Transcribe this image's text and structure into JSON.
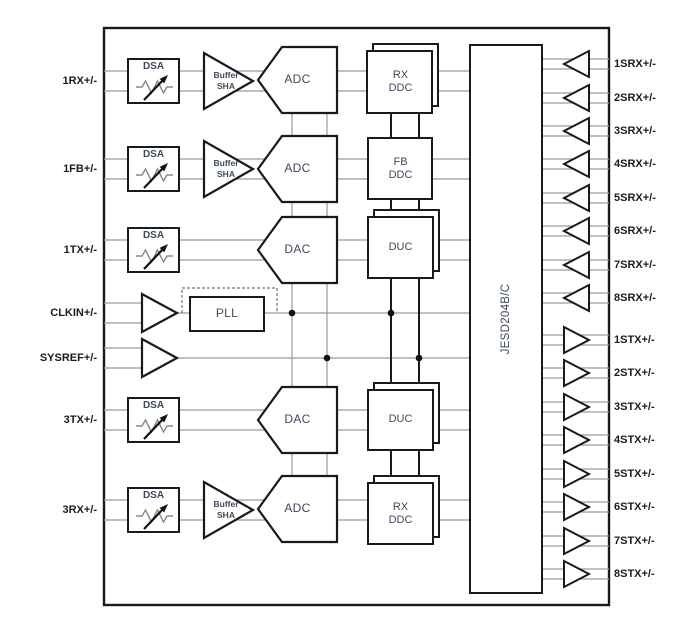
{
  "pins": {
    "left": [
      "1RX+/-",
      "1FB+/-",
      "1TX+/-",
      "CLKIN+/-",
      "SYSREF+/-",
      "3TX+/-",
      "3RX+/-"
    ],
    "srx": [
      "1SRX+/-",
      "2SRX+/-",
      "3SRX+/-",
      "4SRX+/-",
      "5SRX+/-",
      "6SRX+/-",
      "7SRX+/-",
      "8SRX+/-"
    ],
    "stx": [
      "1STX+/-",
      "2STX+/-",
      "3STX+/-",
      "4STX+/-",
      "5STX+/-",
      "6STX+/-",
      "7STX+/-",
      "8STX+/-"
    ]
  },
  "blocks": {
    "dsa": "DSA",
    "buffer_sha": "Buffer\nSHA",
    "adc": "ADC",
    "dac": "DAC",
    "rx_ddc": "RX\nDDC",
    "fb_ddc": "FB\nDDC",
    "duc": "DUC",
    "pll": "PLL",
    "jesd": "JESD204B/C"
  },
  "colors": {
    "block_border": "#1a1a1a",
    "block_text": "#3e4a5c",
    "pin_text": "#1c1c1c",
    "wire": "#9a9a9a"
  }
}
